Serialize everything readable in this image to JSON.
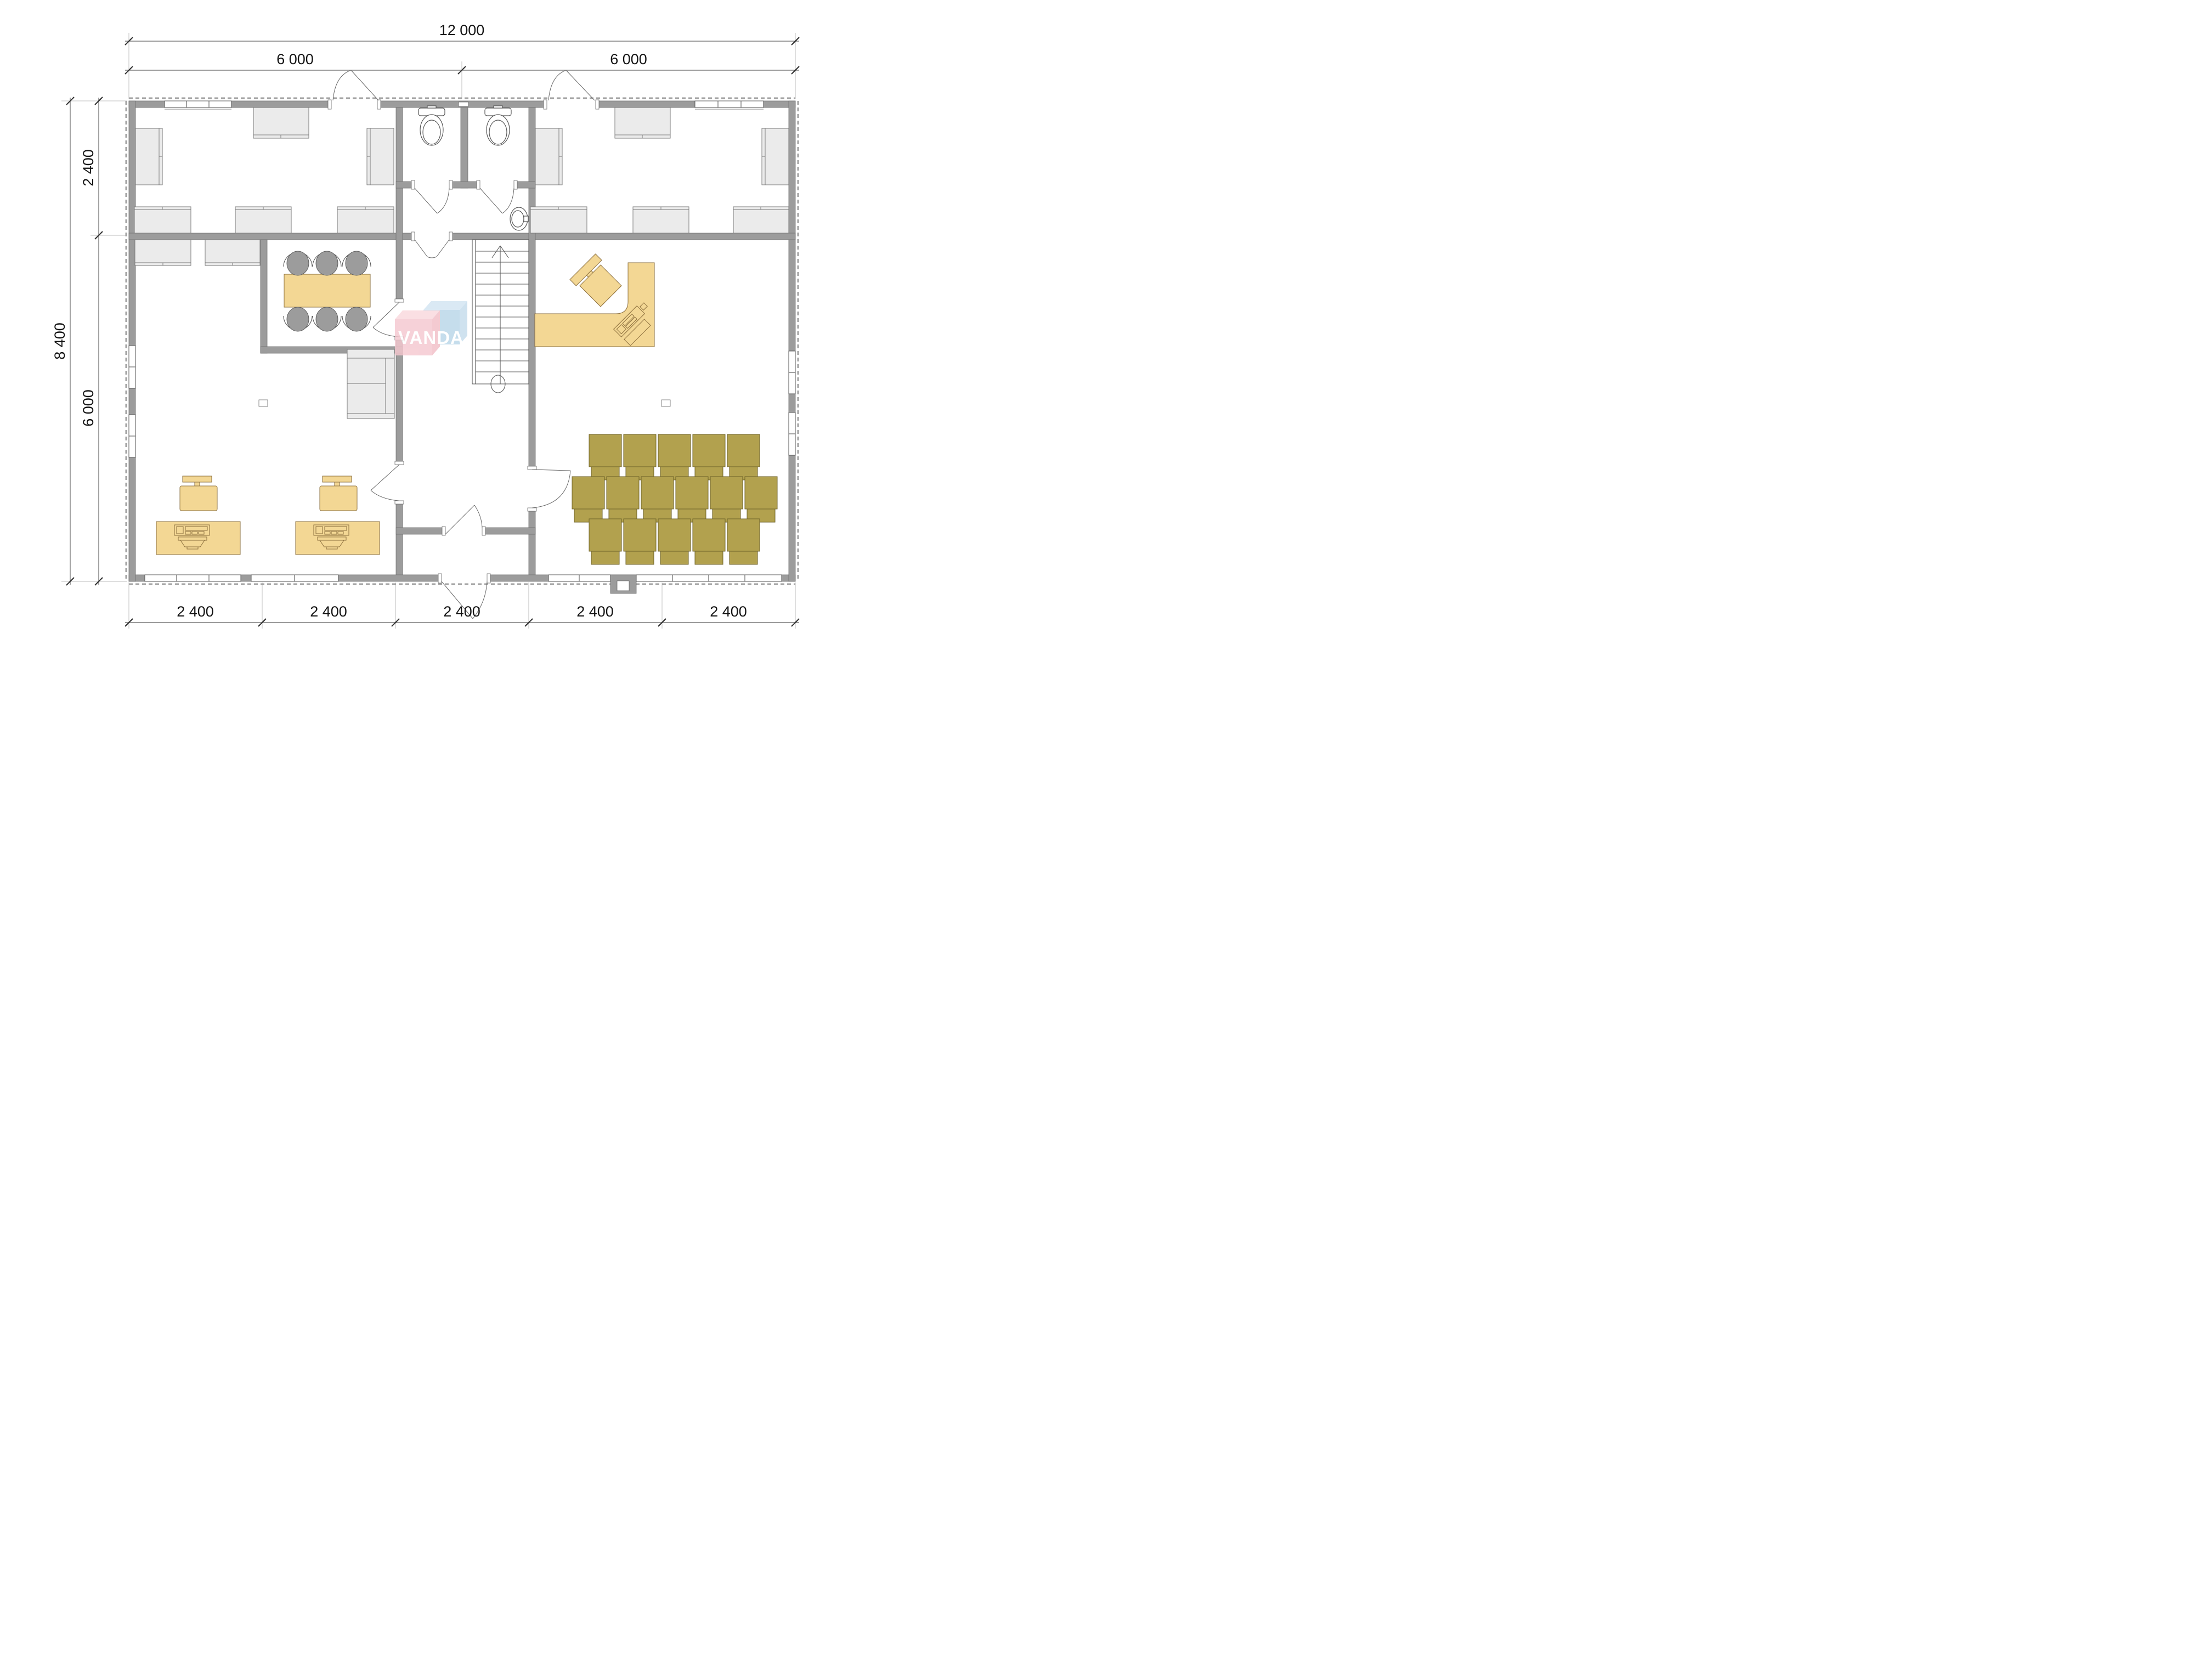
{
  "title": "office floor plan drawing",
  "watermark": {
    "text": "VANDA",
    "pink": "#f5c8d0",
    "blue": "#b9d6e8"
  },
  "dimensions": {
    "top_total": "12 000",
    "top_segments": [
      "6 000",
      "6 000"
    ],
    "left_outer": "8 400",
    "left_segments": [
      "2 400",
      "6 000"
    ],
    "bottom_segments": [
      "2 400",
      "2 400",
      "2 400",
      "2 400",
      "2 400"
    ]
  },
  "colors": {
    "wall": "#9c9c9c",
    "furniture_light": "#ebebeb",
    "furniture_wood": "#f3d794",
    "audience_chair": "#b2a14e",
    "meeting_chair": "#9c9c9c",
    "dimension_text": "#141414"
  },
  "elements": [
    "exterior-walls",
    "interior-partitions",
    "windows",
    "door-swings",
    "wc-stall-left-toilet",
    "wc-stall-right-toilet",
    "wash-basin",
    "staircase-up",
    "meeting-table-with-6-chairs",
    "storage-cabinet",
    "office-desks",
    "workstation-desk-with-monitor-and-chair",
    "reception-l-desk-with-chair",
    "audience-chair-rows-5-6-5",
    "floor-marker-left",
    "floor-marker-right"
  ]
}
